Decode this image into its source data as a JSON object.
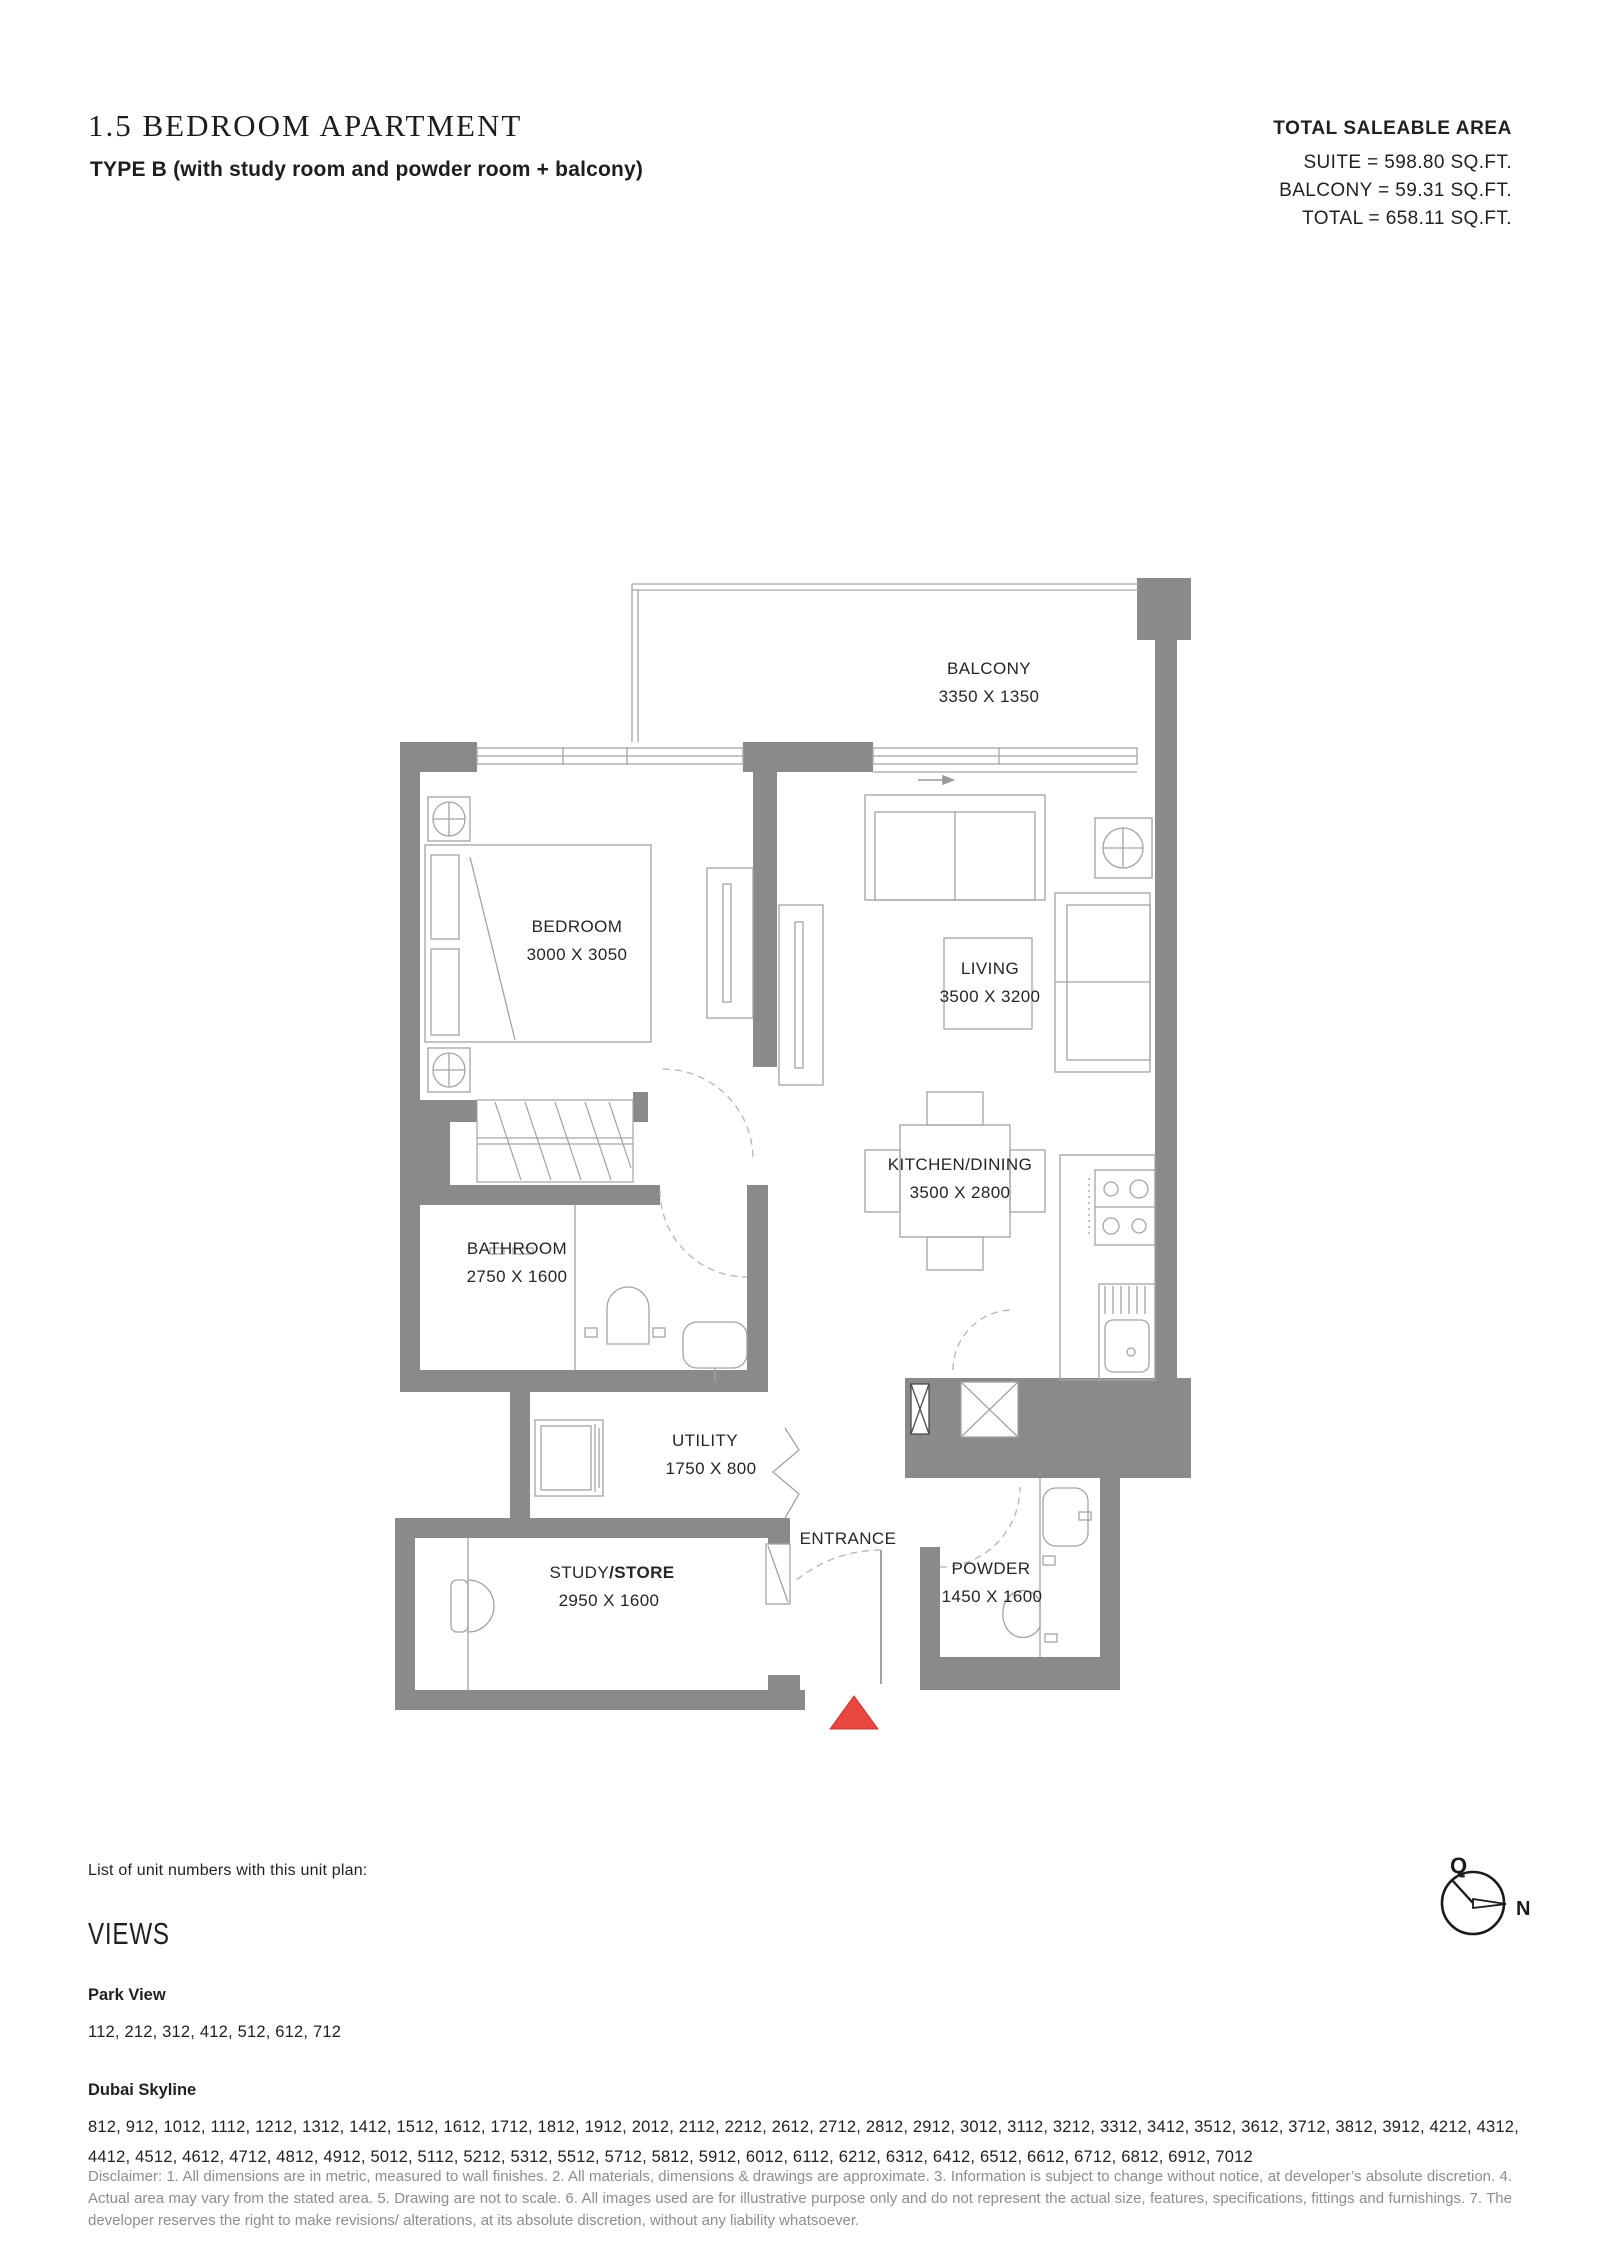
{
  "header": {
    "title": "1.5 BEDROOM APARTMENT",
    "subtitle": "TYPE B (with study room and powder room + balcony)",
    "area": {
      "heading": "TOTAL SALEABLE AREA",
      "lines": [
        "SUITE = 598.80 SQ.FT.",
        "BALCONY = 59.31 SQ.FT.",
        "TOTAL = 658.11 SQ.FT."
      ]
    }
  },
  "floorplan": {
    "rooms": {
      "balcony": {
        "name": "BALCONY",
        "dims": "3350 X 1350"
      },
      "bedroom": {
        "name": "BEDROOM",
        "dims": "3000 X 3050"
      },
      "living": {
        "name": "LIVING",
        "dims": "3500 X 3200"
      },
      "kitchen": {
        "name": "KITCHEN/DINING",
        "dims": "3500 X 2800"
      },
      "bathroom": {
        "name": "BATHROOM",
        "dims": "2750 X 1600"
      },
      "utility": {
        "name": "UTILITY",
        "dims": "1750 X 800"
      },
      "study": {
        "name_regular": "STUDY",
        "name_bold": "/STORE",
        "dims": "2950 X 1600"
      },
      "powder": {
        "name": "POWDER",
        "dims": "1450 X 1600"
      },
      "entrance": {
        "name": "ENTRANCE"
      }
    },
    "colors": {
      "wall": "#8a8a8a",
      "furniture_line": "#a3a3a3",
      "dashed_line": "#b5b5b5",
      "label_text": "#262626",
      "entrance_marker_red": "#e8463f"
    }
  },
  "compass": {
    "q_label": "Q",
    "n_label": "N"
  },
  "units": {
    "intro": "List of unit numbers with this unit plan:",
    "views_heading": "VIEWS",
    "groups": [
      {
        "label": "Park View",
        "numbers": "112, 212, 312, 412, 512, 612, 712"
      },
      {
        "label": "Dubai Skyline",
        "numbers": "812, 912, 1012, 1112, 1212, 1312, 1412, 1512, 1612, 1712, 1812, 1912, 2012, 2112, 2212, 2612, 2712, 2812, 2912, 3012, 3112, 3212, 3312, 3412, 3512, 3612, 3712, 3812, 3912, 4212, 4312, 4412, 4512, 4612, 4712, 4812, 4912, 5012, 5112, 5212, 5312, 5512, 5712, 5812, 5912, 6012, 6112, 6212, 6312, 6412, 6512, 6612, 6712, 6812, 6912, 7012"
      }
    ]
  },
  "disclaimer": "Disclaimer: 1. All dimensions are in metric, measured to wall finishes. 2. All materials, dimensions & drawings are approximate. 3. Information is subject to change without notice, at developer’s absolute discretion. 4. Actual area may vary from the stated area. 5. Drawing are not to scale. 6. All images used are for illustrative purpose only and do not represent the actual size, features, specifications, fittings and furnishings. 7. The developer reserves the right to make revisions/ alterations, at its absolute discretion, without any liability whatsoever."
}
